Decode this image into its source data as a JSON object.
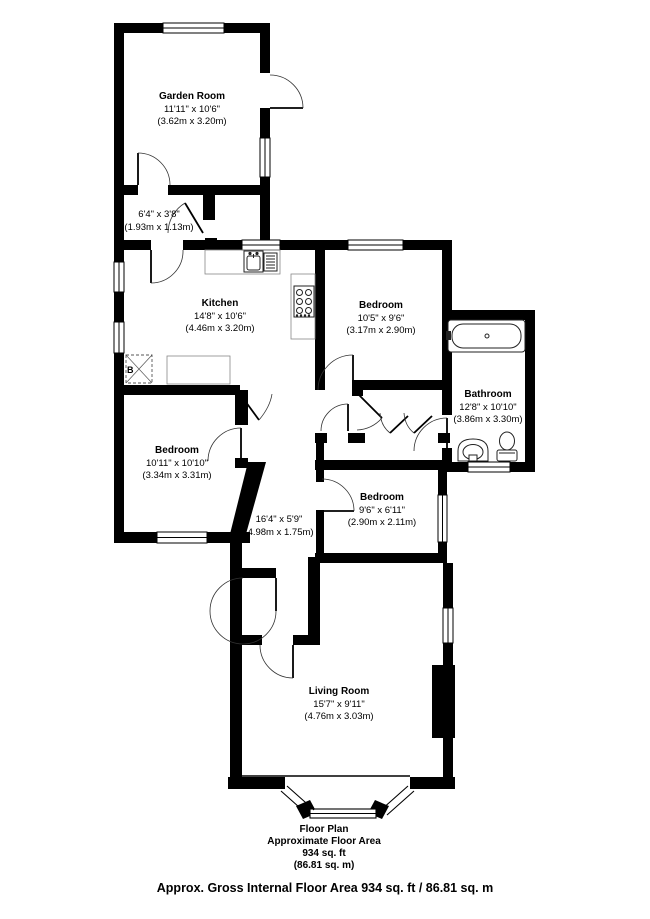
{
  "title": "Floor Plan",
  "rooms": [
    {
      "id": "garden-room",
      "name": "Garden Room",
      "imperial": "11'11\" x 10'6\"",
      "metric": "(3.62m x 3.20m)"
    },
    {
      "id": "lobby",
      "name": "",
      "imperial": "6'4\" x 3'8\"",
      "metric": "(1.93m x 1.13m)"
    },
    {
      "id": "kitchen",
      "name": "Kitchen",
      "imperial": "14'8\" x 10'6\"",
      "metric": "(4.46m x 3.20m)"
    },
    {
      "id": "bedroom-1",
      "name": "Bedroom",
      "imperial": "10'5\" x 9'6\"",
      "metric": "(3.17m x 2.90m)"
    },
    {
      "id": "bathroom",
      "name": "Bathroom",
      "imperial": "12'8\" x 10'10\"",
      "metric": "(3.86m x 3.30m)"
    },
    {
      "id": "bedroom-2",
      "name": "Bedroom",
      "imperial": "10'11\" x 10'10\"",
      "metric": "(3.34m x 3.31m)"
    },
    {
      "id": "hallway",
      "name": "",
      "imperial": "16'4\" x 5'9\"",
      "metric": "(4.98m x 1.75m)"
    },
    {
      "id": "bedroom-3",
      "name": "Bedroom",
      "imperial": "9'6\" x 6'11\"",
      "metric": "(2.90m x 2.11m)"
    },
    {
      "id": "living-room",
      "name": "Living Room",
      "imperial": "15'7\" x 9'11\"",
      "metric": "(4.76m x 3.03m)"
    }
  ],
  "caption": {
    "line1": "Floor Plan",
    "line2": "Approximate Floor Area",
    "line3": "934 sq. ft",
    "line4": "(86.81 sq. m)"
  },
  "footer": "Approx. Gross Internal Floor Area 934 sq. ft / 86.81 sq. m",
  "labels": {
    "boiler": "B"
  },
  "fixtures": [
    "bathtub",
    "washbasin",
    "toilet",
    "kitchen-sink",
    "drainer",
    "hob",
    "boiler-box",
    "counters",
    "chimney-breast",
    "bay-window"
  ],
  "colors": {
    "wall": "#000000",
    "background": "#ffffff",
    "fixture_line": "#222222",
    "counter_line": "#888888"
  }
}
